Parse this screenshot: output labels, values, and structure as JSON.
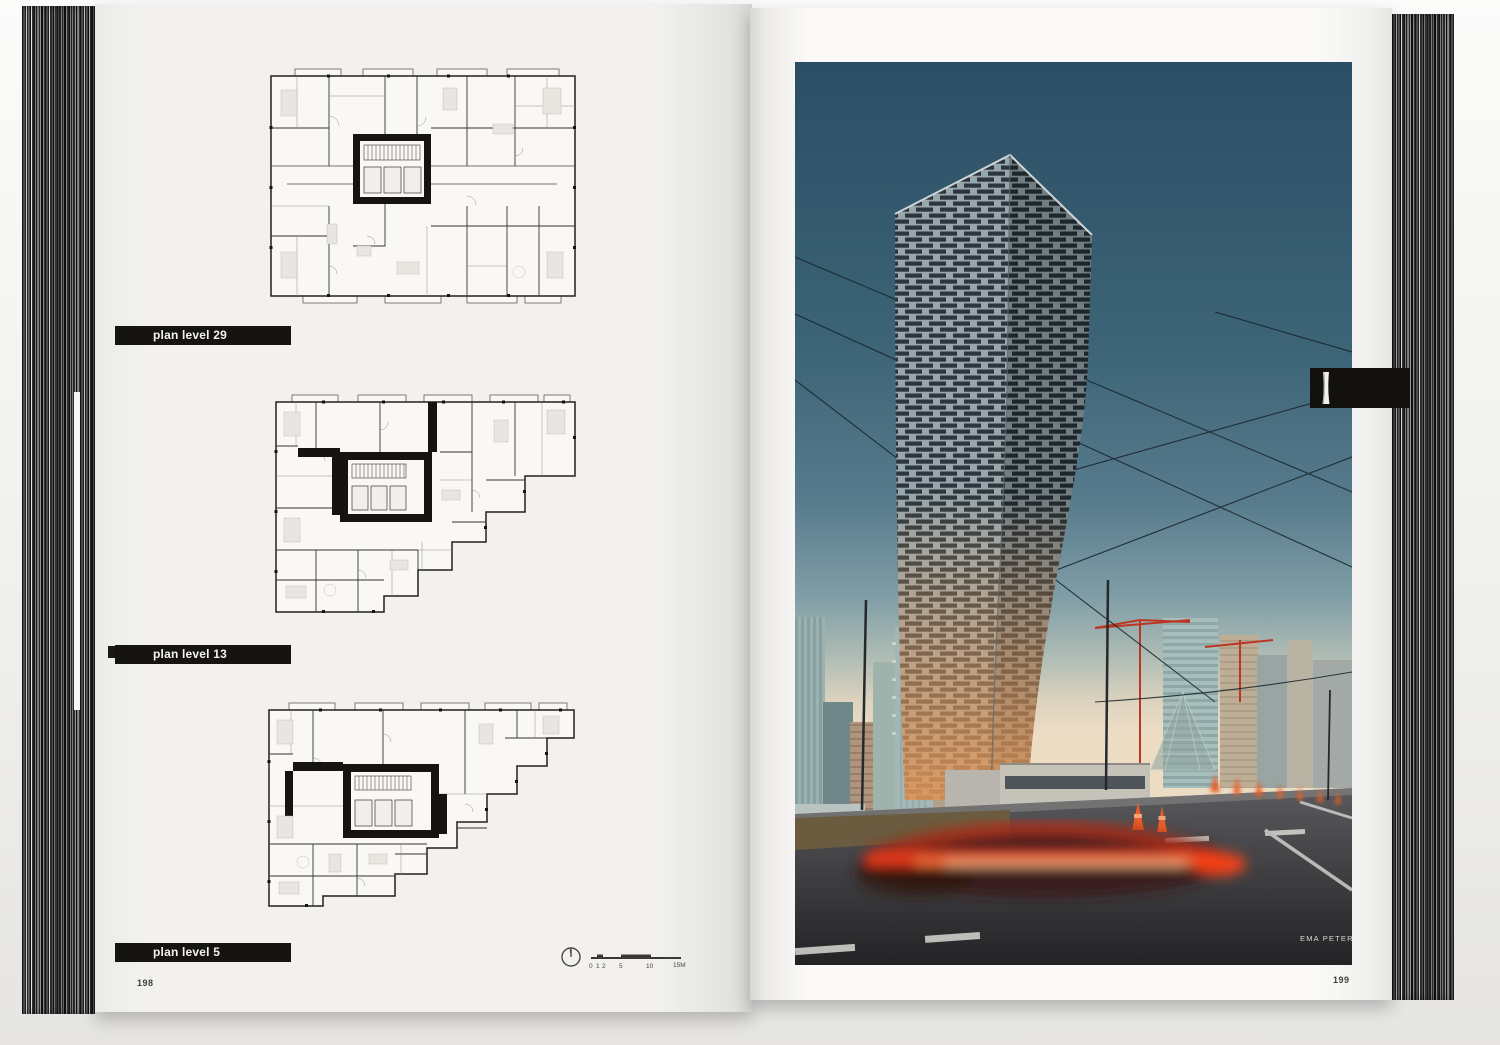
{
  "left_page": {
    "plan_labels": [
      {
        "label": "plan level 29"
      },
      {
        "label": "plan level 13"
      },
      {
        "label": "plan level 5"
      }
    ],
    "page_number": "198",
    "scale_bar": {
      "tick_0": "0",
      "tick_1": "1",
      "tick_2": "2",
      "tick_5": "5",
      "tick_10": "10",
      "tick_15": "15M"
    }
  },
  "right_page": {
    "page_number": "199",
    "photo_credit": "EMA PETER"
  },
  "icons": {
    "north_arrow": "north-arrow-icon",
    "chapter_tab_glyph": "tower-silhouette-icon"
  },
  "colors": {
    "label_bar_bg": "#161412",
    "sky_top": "#2b4e65",
    "cone_orange": "#ea5f28",
    "light_trail_red": "#e73b1c"
  }
}
